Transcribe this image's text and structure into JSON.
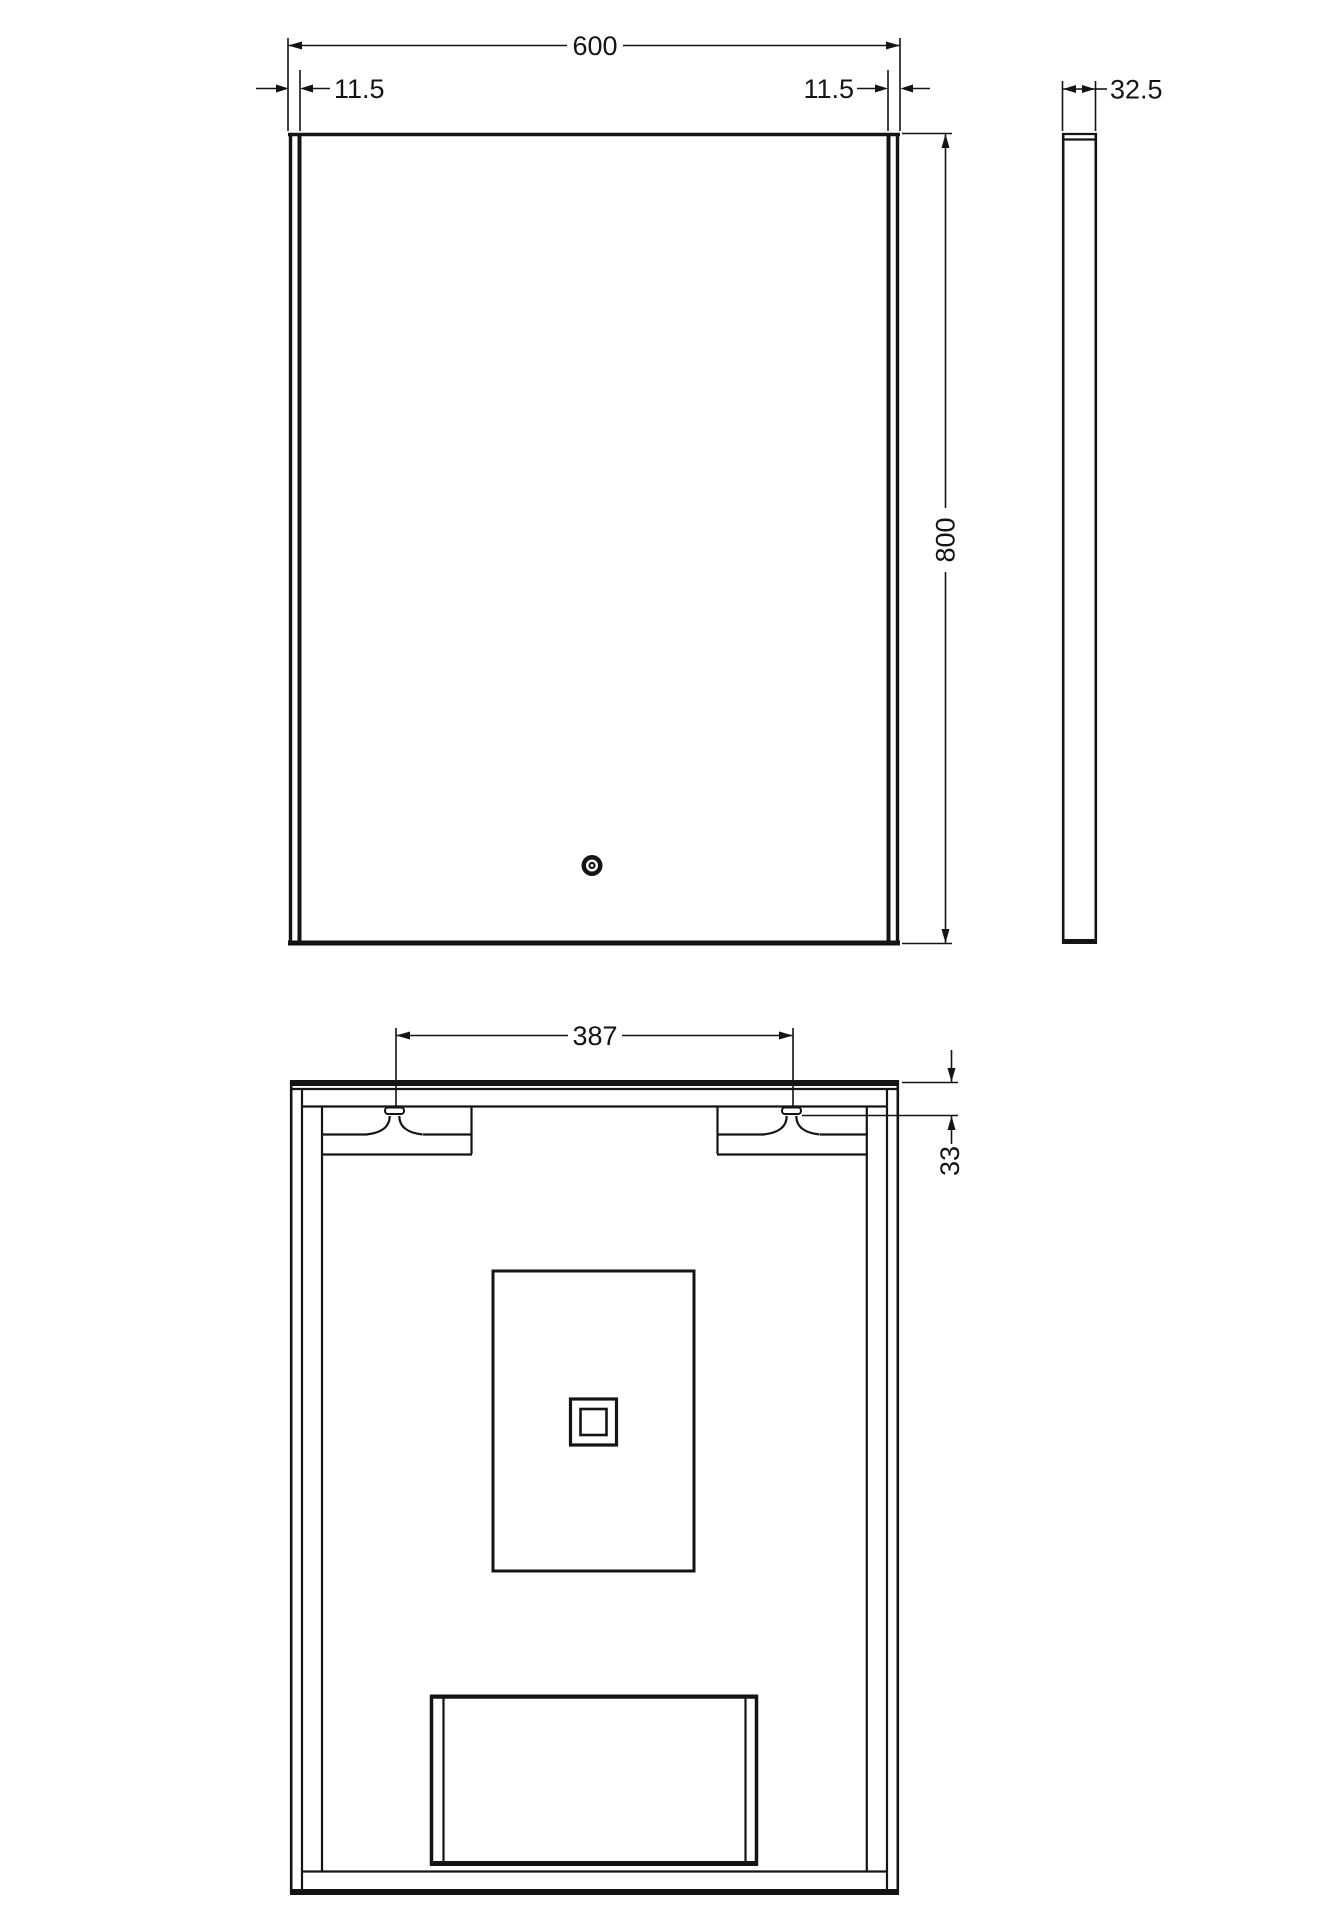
{
  "drawing": {
    "background": "#ffffff",
    "line_color": "#141414",
    "icons": {
      "touch_sensor": "concentric-circles",
      "hanging_bracket": "keyhole-hook"
    },
    "dimensions": {
      "front_width": "600",
      "front_edge_left": "11.5",
      "front_edge_right": "11.5",
      "front_height": "800",
      "side_depth": "32.5",
      "back_bracket_spacing": "387",
      "back_bracket_drop": "33"
    }
  }
}
